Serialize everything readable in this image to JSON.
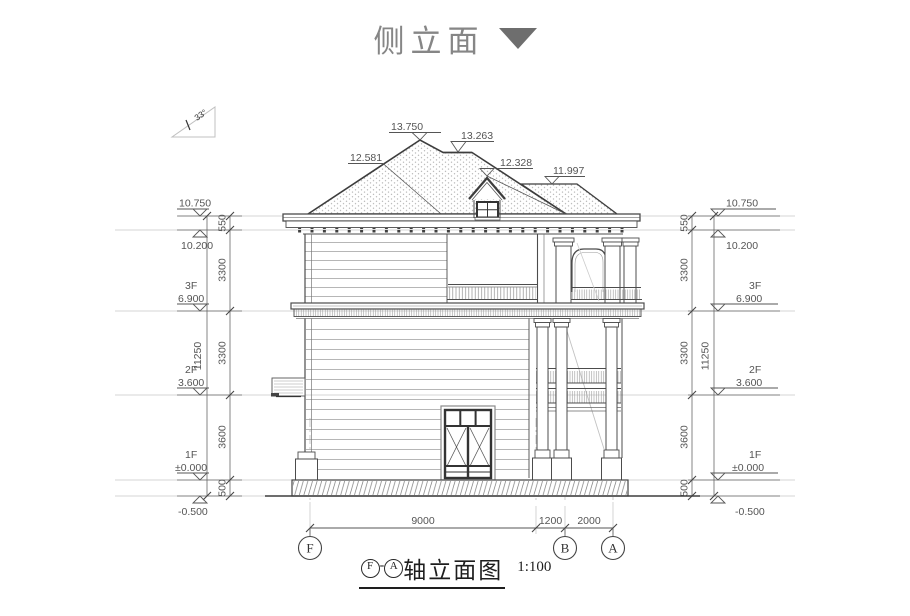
{
  "header": {
    "title": "侧立面"
  },
  "drawing": {
    "slope_label": "33°",
    "roof_marks": {
      "m13750": "13.750",
      "m13263": "13.263",
      "m12581": "12.581",
      "m12328": "12.328",
      "m11997": "11.997"
    },
    "levels": [
      {
        "floor": "",
        "value": "10.750"
      },
      {
        "floor": "",
        "value": "10.200"
      },
      {
        "floor": "3F",
        "value": "6.900"
      },
      {
        "floor": "2F",
        "value": "3.600"
      },
      {
        "floor": "1F",
        "value": "±0.000"
      },
      {
        "floor": "",
        "value": "-0.500"
      }
    ],
    "vertical_segments": [
      "550",
      "3300",
      "3300",
      "3600",
      "500"
    ],
    "vertical_total": "11250",
    "bottom_dims": [
      "9000",
      "1200",
      "2000"
    ],
    "axes": [
      "F",
      "B",
      "A"
    ]
  },
  "caption": {
    "axis_start": "F",
    "separator": "-",
    "axis_end": "A",
    "title": "轴立面图",
    "scale": "1:100"
  },
  "colors": {
    "line": "#4c4c4c",
    "dim_text": "#565656",
    "title_gray": "#868686",
    "arrow_gray": "#6e6e6e",
    "guide": "#c9c9c9"
  }
}
